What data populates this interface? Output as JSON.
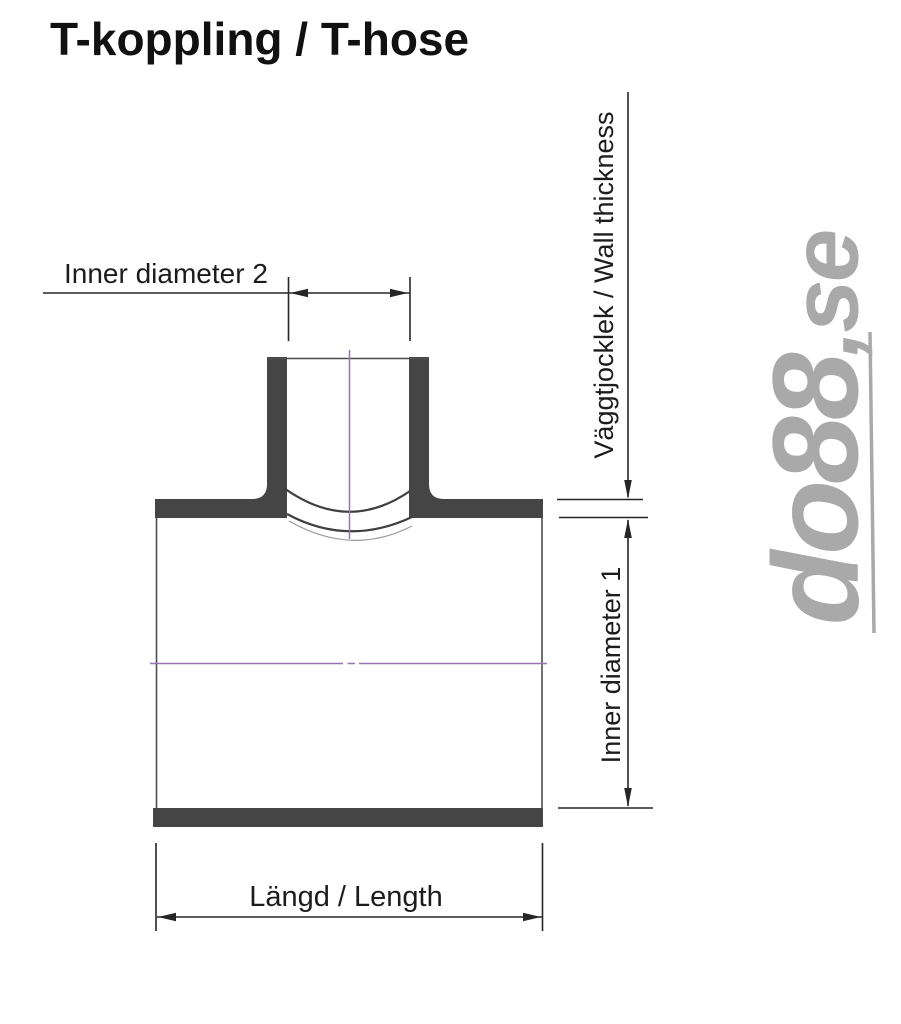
{
  "page": {
    "title": "T-koppling / T-hose"
  },
  "diagram": {
    "type": "technical-drawing",
    "subject": "T-shaped hose coupling, section view with dimension callouts",
    "labels": {
      "inner_diameter_2": "Inner diameter 2",
      "wall_thickness": "Väggtjocklek / Wall thickness",
      "inner_diameter_1": "Inner diameter 1",
      "length": "Längd / Length"
    },
    "watermark": {
      "brand": "do88,se",
      "brand_main": "do88",
      "brand_suffix": ",se"
    },
    "colors": {
      "wall_fill": "#454545",
      "outline": "#4f4f4f",
      "dimension": "#262626",
      "centerline": "#9673b5",
      "watermark": "#a9a9a9",
      "background": "#ffffff",
      "text": "#111111"
    }
  }
}
